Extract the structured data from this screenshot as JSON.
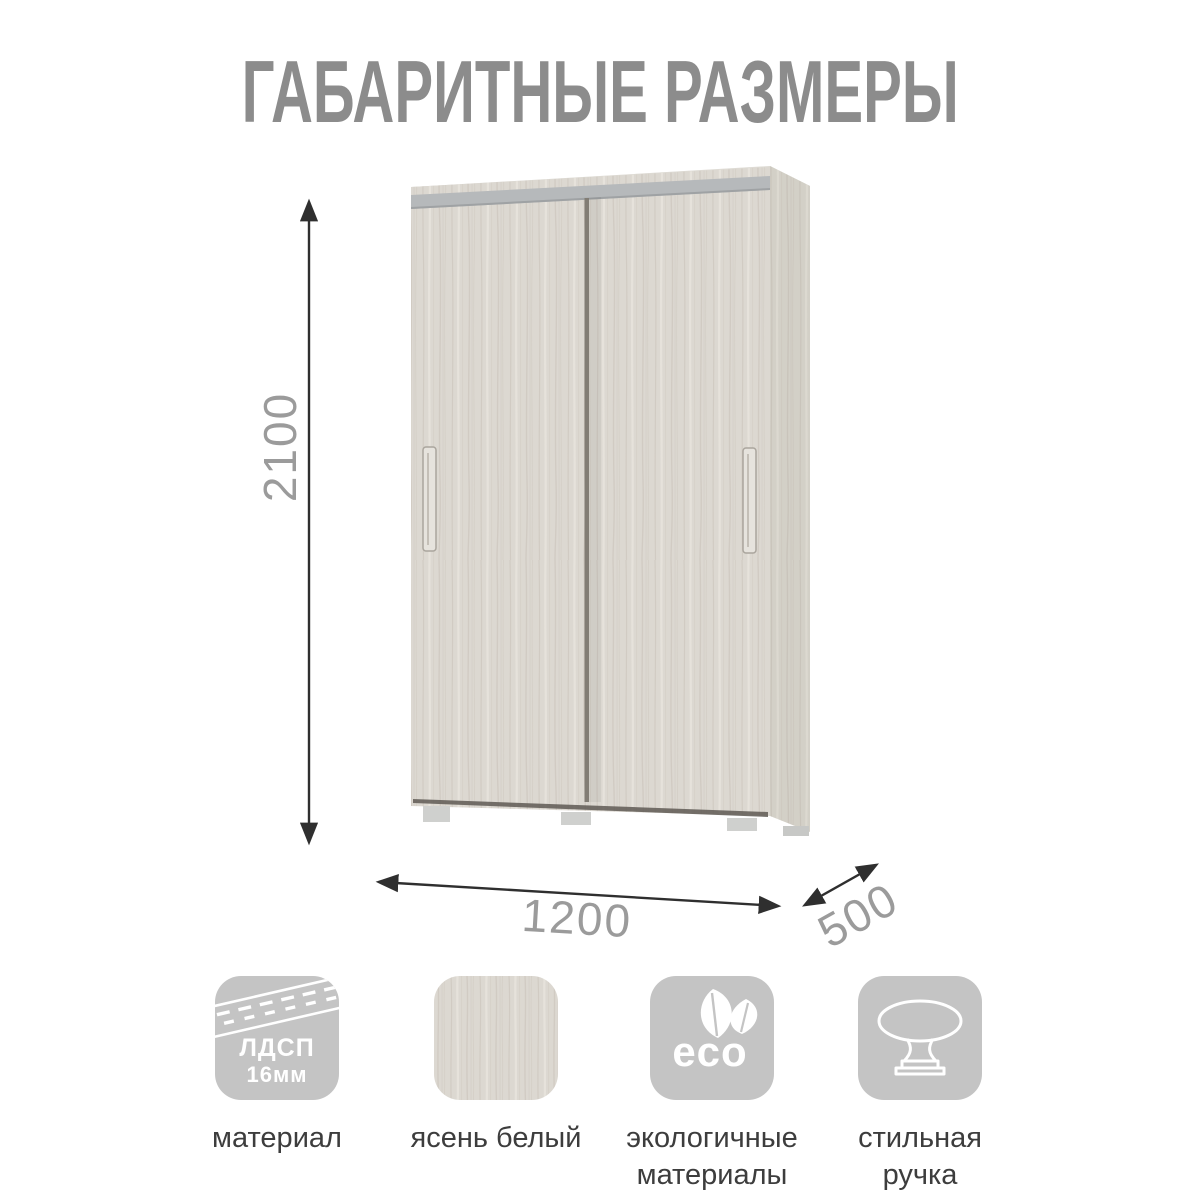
{
  "title": "ГАБАРИТНЫЕ РАЗМЕРЫ",
  "dimensions": {
    "height": "2100",
    "width": "1200",
    "depth": "500"
  },
  "colors": {
    "title_gray": "#8c8c8c",
    "dimension_text": "#9b9b9b",
    "arrow": "#2f2f2f",
    "wood_light": "#dcd8d1",
    "track_gray": "#b6b9bb",
    "icon_tile_gray": "#c4c4c4",
    "caption_text": "#3d3d3d"
  },
  "features": [
    {
      "icon": "chipboard-edge-icon",
      "badge_line1": "ЛДСП",
      "badge_line2": "16мм",
      "caption_line1": "материал",
      "caption_line2": ""
    },
    {
      "icon": "wood-swatch-icon",
      "caption_line1": "ясень белый",
      "caption_line2": ""
    },
    {
      "icon": "eco-leaves-icon",
      "badge": "eco",
      "caption_line1": "экологичные",
      "caption_line2": "материалы"
    },
    {
      "icon": "knob-icon",
      "caption_line1": "стильная",
      "caption_line2": "ручка"
    }
  ]
}
